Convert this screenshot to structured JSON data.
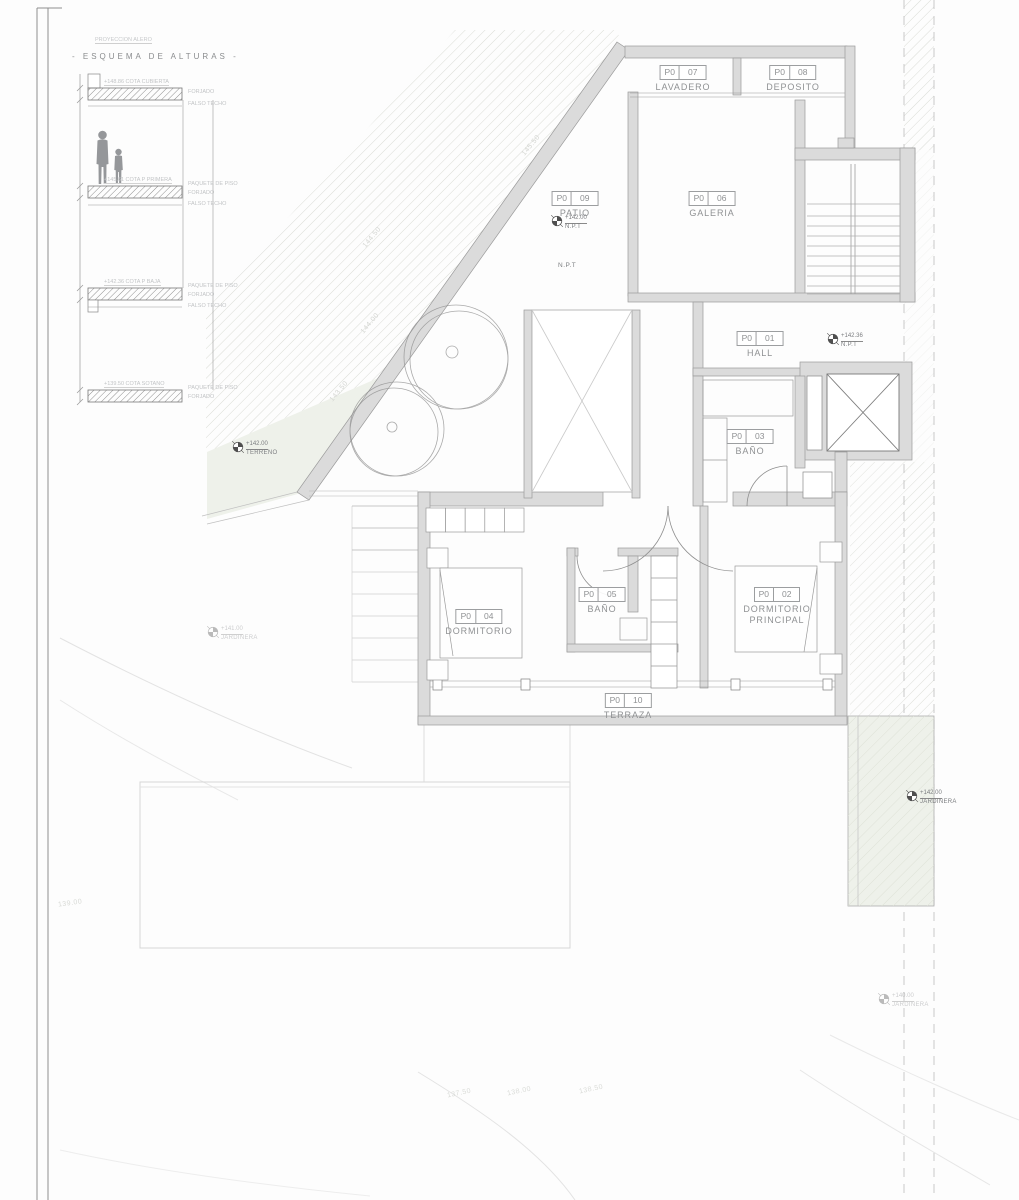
{
  "sheet": {
    "background": "#fdfdfd",
    "wall_fill": "#dbdbdb",
    "line_color": "#9a9a9a",
    "label_text_color": "#8f9193",
    "faint_text_color": "#c6c8ca",
    "garden_tint": "#eef1ea"
  },
  "schema": {
    "note": "PROYECCION ALERO",
    "title": "- ESQUEMA DE ALTURAS -",
    "levels": [
      {
        "cota": "+148.86 COTA CUBIERTA",
        "annotations": [
          "FORJADO",
          "FALSO TECHO"
        ]
      },
      {
        "cota": "+145.61 COTA P PRIMERA",
        "annotations": [
          "PAQUETE DE PISO",
          "FORJADO",
          "FALSO TECHO"
        ]
      },
      {
        "cota": "+142.36 COTA P BAJA",
        "annotations": [
          "PAQUETE DE PISO",
          "FORJADO",
          "FALSO TECHO"
        ]
      },
      {
        "cota": "+139.50 COTA SOTANO",
        "annotations": [
          "PAQUETE DE PISO",
          "FORJADO"
        ]
      }
    ]
  },
  "rooms": [
    {
      "code": "P0",
      "num": "07",
      "name": "LAVADERO"
    },
    {
      "code": "P0",
      "num": "08",
      "name": "DEPOSITO"
    },
    {
      "code": "P0",
      "num": "09",
      "name": "PATIO"
    },
    {
      "code": "P0",
      "num": "06",
      "name": "GALERIA"
    },
    {
      "code": "P0",
      "num": "01",
      "name": "HALL"
    },
    {
      "code": "P0",
      "num": "03",
      "name": "BAÑO"
    },
    {
      "code": "P0",
      "num": "04",
      "name": "DORMITORIO"
    },
    {
      "code": "P0",
      "num": "05",
      "name": "BAÑO"
    },
    {
      "code": "P0",
      "num": "02",
      "name": "DORMITORIO PRINCIPAL"
    },
    {
      "code": "P0",
      "num": "10",
      "name": "TERRAZA"
    }
  ],
  "markers": [
    {
      "value": "+142.00",
      "label": "N.P.T"
    },
    {
      "value": "+142.36",
      "label": "N.P.T"
    },
    {
      "value": "+142.00",
      "label": "TERRENO"
    },
    {
      "value": "+142.00",
      "label": "JARDINERA"
    },
    {
      "value": "+141.00",
      "label": "JARDINERA"
    },
    {
      "value": "+140.00",
      "label": "JARDINERA"
    }
  ],
  "annotations": {
    "npt": "N.P.T"
  },
  "contours": [
    "144.50",
    "144.00",
    "143.50",
    "145.50",
    "137.50",
    "138.00",
    "138.50",
    "139.00"
  ]
}
